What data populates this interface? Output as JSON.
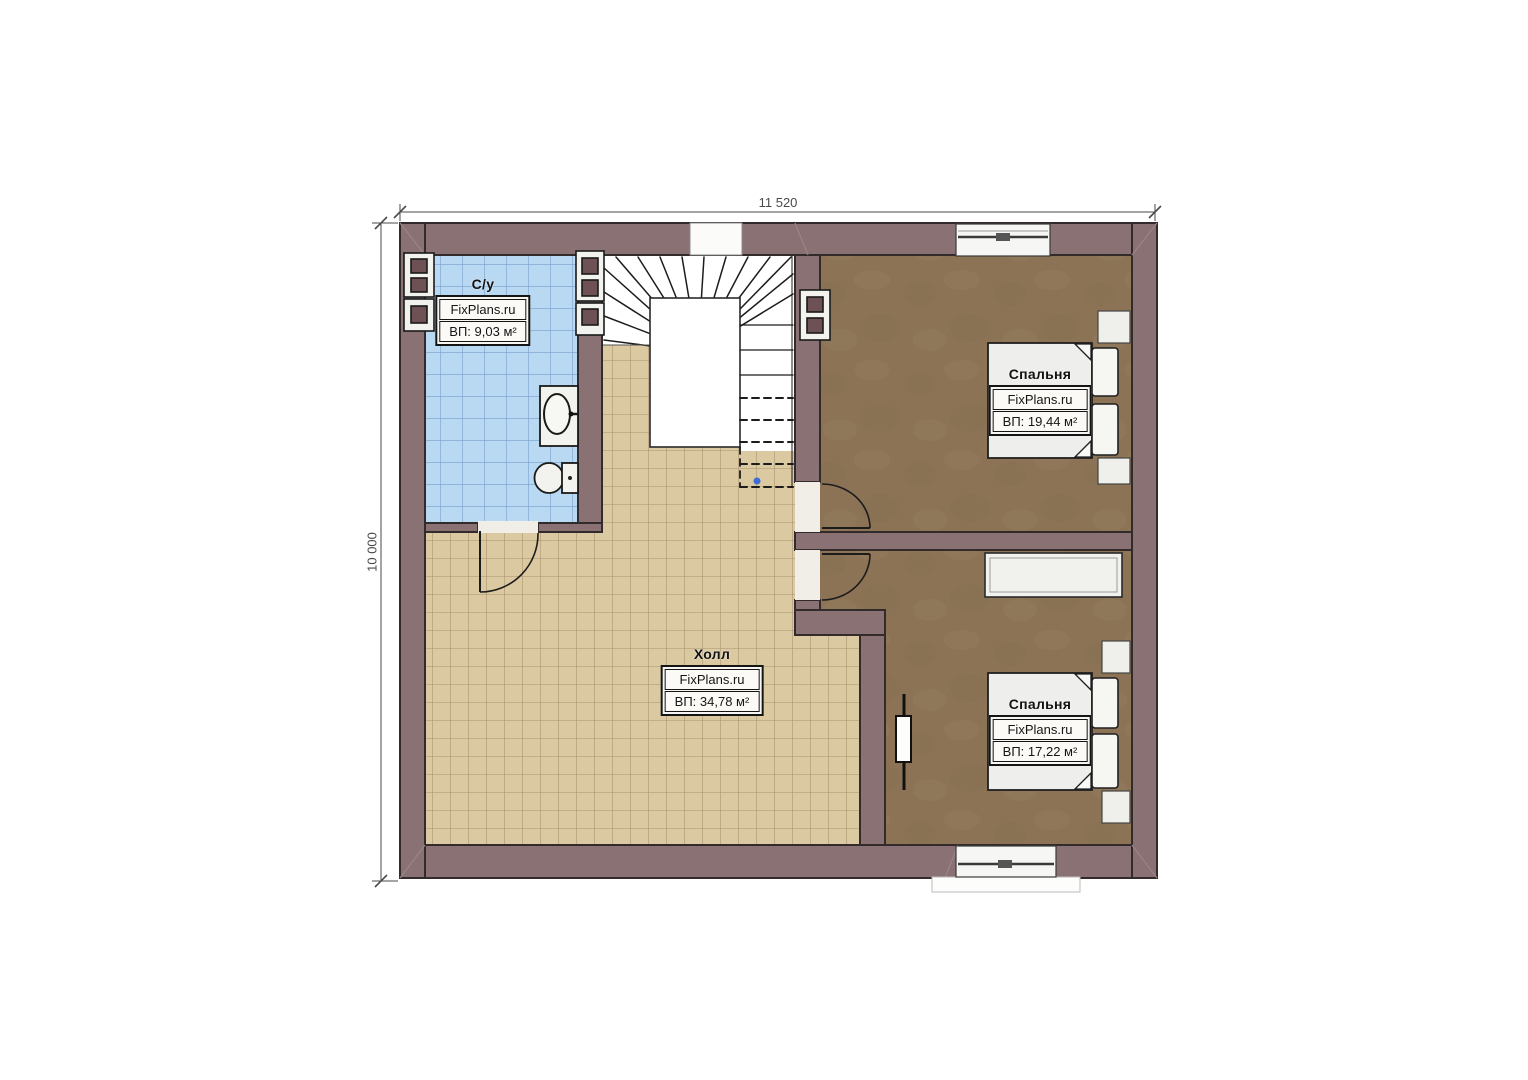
{
  "plan": {
    "title": "floor-plan",
    "dimensions": {
      "top": "11 520",
      "left": "10 000"
    },
    "rooms": [
      {
        "key": "bathroom",
        "name": "С/у",
        "watermark": "FixPlans.ru",
        "area": "ВП: 9,03 м²"
      },
      {
        "key": "hall",
        "name": "Холл",
        "watermark": "FixPlans.ru",
        "area": "ВП: 34,78 м²"
      },
      {
        "key": "bedroom-top",
        "name": "Спальня",
        "watermark": "FixPlans.ru",
        "area": "ВП: 19,44 м²"
      },
      {
        "key": "bedroom-bottom",
        "name": "Спальня",
        "watermark": "FixPlans.ru",
        "area": "ВП: 17,22 м²"
      }
    ],
    "colors": {
      "wall": "#8a7174",
      "wall_outline": "#332a2c",
      "bathroom_floor": "#b9d8f2",
      "bathroom_grid": "#79a0cd",
      "hall_floor": "#dbc9a2",
      "hall_grid": "#a6926b",
      "bedroom_floor": "#8c7356",
      "fixture_fill": "#f2f2ee",
      "dimension_line": "#4a4a4a",
      "stair_dot": "#3f6cd8"
    }
  }
}
